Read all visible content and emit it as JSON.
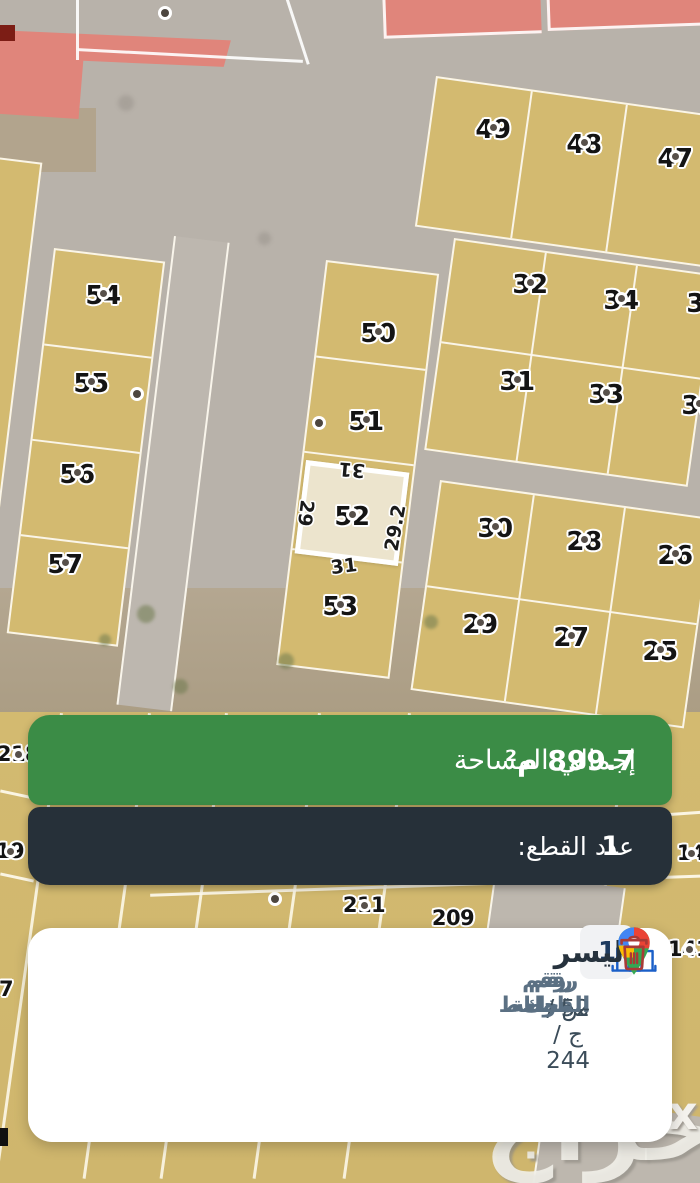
{
  "colors": {
    "accent_green": "#3b8c46",
    "banner_dark": "#263039",
    "plot_tan": "#d3ba70",
    "selected_plot_fill": "#ece4cd",
    "red_plot": "#e0857b",
    "building_icon_blue": "#1a5fc8",
    "trash_icon_red": "#a93a36",
    "badge_text_navy": "#1d3a5f",
    "field_label_slate": "#5b7083"
  },
  "map": {
    "watermark": "حراج",
    "watermark_mark": "x",
    "plot_labels": [
      {
        "n": "49",
        "x": 493,
        "y": 117
      },
      {
        "n": "48",
        "x": 584,
        "y": 132
      },
      {
        "n": "47",
        "x": 675,
        "y": 146
      },
      {
        "n": "32",
        "x": 530,
        "y": 272
      },
      {
        "n": "34",
        "x": 621,
        "y": 288
      },
      {
        "n": "36",
        "x": 704,
        "y": 291,
        "dot": false
      },
      {
        "n": "31",
        "x": 517,
        "y": 369
      },
      {
        "n": "33",
        "x": 606,
        "y": 382
      },
      {
        "n": "35",
        "x": 699,
        "y": 393
      },
      {
        "n": "30",
        "x": 495,
        "y": 516
      },
      {
        "n": "28",
        "x": 584,
        "y": 529
      },
      {
        "n": "26",
        "x": 675,
        "y": 543
      },
      {
        "n": "29",
        "x": 480,
        "y": 612
      },
      {
        "n": "27",
        "x": 571,
        "y": 625
      },
      {
        "n": "25",
        "x": 660,
        "y": 639
      },
      {
        "n": "54",
        "x": 103,
        "y": 283
      },
      {
        "n": "55",
        "x": 91,
        "y": 371
      },
      {
        "n": "56",
        "x": 77,
        "y": 462
      },
      {
        "n": "57",
        "x": 65,
        "y": 552
      },
      {
        "n": "50",
        "x": 378,
        "y": 321
      },
      {
        "n": "51",
        "x": 366,
        "y": 409
      },
      {
        "n": "52",
        "x": 352,
        "y": 504
      },
      {
        "n": "53",
        "x": 340,
        "y": 594
      },
      {
        "n": "218",
        "x": 18,
        "y": 744,
        "s": 21
      },
      {
        "n": "19",
        "x": 10,
        "y": 841,
        "s": 21
      },
      {
        "n": "211",
        "x": 364,
        "y": 895,
        "s": 21
      },
      {
        "n": "209",
        "x": 453,
        "y": 908,
        "s": 21,
        "dot": false
      },
      {
        "n": "14",
        "x": 691,
        "y": 843,
        "s": 21
      },
      {
        "n": "141",
        "x": 689,
        "y": 939,
        "s": 21
      },
      {
        "n": "7",
        "x": 6,
        "y": 979,
        "s": 21,
        "dot": false
      }
    ],
    "extra_dots": [
      {
        "x": 165,
        "y": 13
      },
      {
        "x": 137,
        "y": 394
      },
      {
        "x": 319,
        "y": 423
      },
      {
        "x": 275,
        "y": 899
      }
    ],
    "selected": {
      "number": "52",
      "dims": {
        "top": "31",
        "left": "29",
        "right": "29.2",
        "bottom": "31"
      }
    }
  },
  "area_banner": {
    "label": "إجمالي المساحة",
    "value": "899.7 م²"
  },
  "count_banner": {
    "label": "عدد القطع:",
    "value": "1"
  },
  "card": {
    "badge_count": "1",
    "district_name": "اليسر",
    "fields": [
      {
        "label": "رقم القطعة",
        "value": "52"
      },
      {
        "label": "رقم المخطط",
        "value": "س / ج / 244"
      },
      {
        "label": "رقم البلوك",
        "value": "-"
      }
    ]
  }
}
